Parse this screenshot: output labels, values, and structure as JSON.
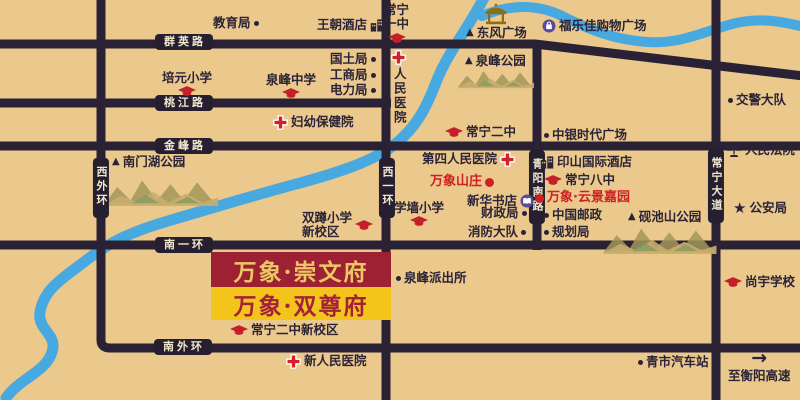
{
  "colors": {
    "background": "#ebc88c",
    "road": "#2a2234",
    "badge_text": "#f2e8cd",
    "river": "#48a9e0",
    "accent_red": "#ce2127",
    "icon_purple": "#5b4a9e",
    "banner1_bg": "#9d2133",
    "banner1_text": "#edc763",
    "banner2_bg": "#f3c41c",
    "banner2_text": "#a22338"
  },
  "banners": [
    {
      "id": "chongwenfu",
      "text": "万象·崇文府"
    },
    {
      "id": "shuangzunfu",
      "text": "万象·双尊府"
    }
  ],
  "road_badges": [
    {
      "id": "qunying-road",
      "label": "群英路",
      "dir": "h",
      "cx": 184,
      "cy": 42
    },
    {
      "id": "taojiang-road",
      "label": "桃江路",
      "dir": "h",
      "cx": 184,
      "cy": 103
    },
    {
      "id": "jinfeng-road",
      "label": "金峰路",
      "dir": "h",
      "cx": 184,
      "cy": 146
    },
    {
      "id": "nanyihuan-road",
      "label": "南一环",
      "dir": "h",
      "cx": 184,
      "cy": 245
    },
    {
      "id": "nanwaihuan-road",
      "label": "南外环",
      "dir": "h",
      "cx": 183,
      "cy": 347
    },
    {
      "id": "xiwaihuan-road",
      "label": "西外环",
      "dir": "v",
      "cx": 101,
      "cy": 188
    },
    {
      "id": "xiyihuan-road",
      "label": "西一环",
      "dir": "v",
      "cx": 387,
      "cy": 188
    },
    {
      "id": "qingyang-south-road",
      "label": "青阳南路",
      "dir": "v",
      "cx": 537,
      "cy": 187
    },
    {
      "id": "changning-avenue",
      "label": "常宁大道",
      "dir": "v",
      "cx": 716,
      "cy": 186
    }
  ],
  "pois": [
    {
      "id": "education-bureau",
      "label": "教育局",
      "icon": "dot",
      "icon_pos": "right",
      "x": 213,
      "y": 16
    },
    {
      "id": "wangchao-hotel",
      "label": "王朝酒店",
      "icon": "building",
      "icon_pos": "right",
      "x": 317,
      "y": 18
    },
    {
      "id": "changning-no1-middle-school",
      "lines": [
        "常宁",
        "一中"
      ],
      "label": "常宁一中",
      "icon": "cap",
      "icon_pos": "below",
      "x": 384,
      "y": 3
    },
    {
      "id": "dongfeng-square",
      "label": "东风广场",
      "icon": "triangle",
      "icon_pos": "left",
      "x": 466,
      "y": 26
    },
    {
      "id": "fulejia-shopping-plaza",
      "label": "福乐佳购物广场",
      "icon": "shop",
      "icon_pos": "left",
      "x": 542,
      "y": 19
    },
    {
      "id": "peiyuan-primary-school",
      "label": "培元小学",
      "icon": "cap",
      "icon_pos": "below",
      "x": 162,
      "y": 71
    },
    {
      "id": "quanfeng-middle-school",
      "label": "泉峰中学",
      "icon": "cap",
      "icon_pos": "below",
      "x": 266,
      "y": 73
    },
    {
      "id": "land-bureau",
      "label": "国土局",
      "icon": "dot",
      "icon_pos": "right",
      "x": 330,
      "y": 52
    },
    {
      "id": "industry-commerce-bureau",
      "label": "工商局",
      "icon": "dot",
      "icon_pos": "right",
      "x": 330,
      "y": 68
    },
    {
      "id": "power-bureau",
      "label": "电力局",
      "icon": "dot",
      "icon_pos": "right",
      "x": 330,
      "y": 83
    },
    {
      "id": "peoples-hospital",
      "label": "人民医院",
      "icon": "cross",
      "icon_pos": "above",
      "vertical": true,
      "x": 391,
      "y": 50
    },
    {
      "id": "quanfeng-park",
      "label": "泉峰公园",
      "icon": "triangle",
      "icon_pos": "left",
      "x": 465,
      "y": 54
    },
    {
      "id": "maternal-child-hospital",
      "label": "妇幼保健院",
      "icon": "cross",
      "icon_pos": "left",
      "x": 273,
      "y": 115
    },
    {
      "id": "traffic-police-brigade",
      "label": "交警大队",
      "icon": "dot",
      "icon_pos": "left",
      "x": 728,
      "y": 93
    },
    {
      "id": "changning-no2-middle-school",
      "label": "常宁二中",
      "icon": "cap",
      "icon_pos": "left",
      "x": 445,
      "y": 125
    },
    {
      "id": "zhongyin-times-square",
      "label": "中银时代广场",
      "icon": "dot",
      "icon_pos": "left",
      "x": 544,
      "y": 128
    },
    {
      "id": "nanmenhu-park",
      "label": "南门湖公园",
      "icon": "triangle",
      "icon_pos": "left",
      "x": 112,
      "y": 155
    },
    {
      "id": "fourth-peoples-hospital",
      "label": "第四人民医院",
      "icon": "cross",
      "icon_pos": "right",
      "x": 422,
      "y": 152
    },
    {
      "id": "wanxiang-villa",
      "label": "万象山庄",
      "icon": "reddot",
      "icon_pos": "right",
      "red": true,
      "x": 430,
      "y": 175
    },
    {
      "id": "yinshan-international-hotel",
      "label": "印山国际酒店",
      "icon": "building",
      "icon_pos": "left",
      "x": 540,
      "y": 155
    },
    {
      "id": "changning-no8-middle-school",
      "label": "常宁八中",
      "icon": "cap",
      "icon_pos": "left",
      "x": 544,
      "y": 173
    },
    {
      "id": "wanxiang-yunjing-garden",
      "label": "万象·云景嘉园",
      "icon": "reddot",
      "icon_pos": "left",
      "red": true,
      "x": 535,
      "y": 191
    },
    {
      "id": "xinhua-bookstore",
      "label": "新华书店",
      "icon": "book",
      "icon_pos": "right",
      "x": 467,
      "y": 194
    },
    {
      "id": "finance-bureau",
      "label": "财政局",
      "icon": "dot",
      "icon_pos": "right",
      "x": 481,
      "y": 206
    },
    {
      "id": "fire-brigade",
      "label": "消防大队",
      "icon": "dot",
      "icon_pos": "right",
      "x": 468,
      "y": 225
    },
    {
      "id": "china-post",
      "label": "中国邮政",
      "icon": "dot",
      "icon_pos": "left",
      "x": 544,
      "y": 208
    },
    {
      "id": "planning-bureau",
      "label": "规划局",
      "icon": "dot",
      "icon_pos": "left",
      "x": 544,
      "y": 225
    },
    {
      "id": "peoples-court",
      "label": "人民法院",
      "icon": "scales",
      "icon_pos": "left",
      "x": 726,
      "y": 143
    },
    {
      "id": "public-security-bureau",
      "label": "公安局",
      "icon": "star",
      "icon_pos": "left",
      "x": 733,
      "y": 201
    },
    {
      "id": "yanchishan-park",
      "label": "砚池山公园",
      "icon": "triangle",
      "icon_pos": "left",
      "x": 628,
      "y": 210
    },
    {
      "id": "xueqiang-primary-school",
      "label": "学墙小学",
      "icon": "cap",
      "icon_pos": "below",
      "x": 394,
      "y": 201
    },
    {
      "id": "shuangdun-primary-school",
      "lines": [
        "双蹲小学",
        "新校区"
      ],
      "label": "双蹲小学新校区",
      "icon": "cap",
      "icon_pos": "right",
      "x": 302,
      "y": 211
    },
    {
      "id": "quanfeng-police-station",
      "label": "泉峰派出所",
      "icon": "dot",
      "icon_pos": "left",
      "x": 396,
      "y": 271
    },
    {
      "id": "changning-no2-new-campus",
      "label": "常宁二中新校区",
      "icon": "cap",
      "icon_pos": "left",
      "x": 230,
      "y": 323
    },
    {
      "id": "new-peoples-hospital",
      "label": "新人民医院",
      "icon": "cross",
      "icon_pos": "left",
      "x": 286,
      "y": 354
    },
    {
      "id": "shangyu-school",
      "label": "尚宇学校",
      "icon": "cap",
      "icon_pos": "left",
      "x": 724,
      "y": 275
    },
    {
      "id": "qingshi-bus-station",
      "label": "青市汽车站",
      "icon": "dot",
      "icon_pos": "left",
      "x": 638,
      "y": 355
    },
    {
      "id": "to-hengyang-expressway",
      "label": "至衡阳高速",
      "icon": "arrow",
      "icon_pos": "above",
      "x": 728,
      "y": 349
    }
  ]
}
